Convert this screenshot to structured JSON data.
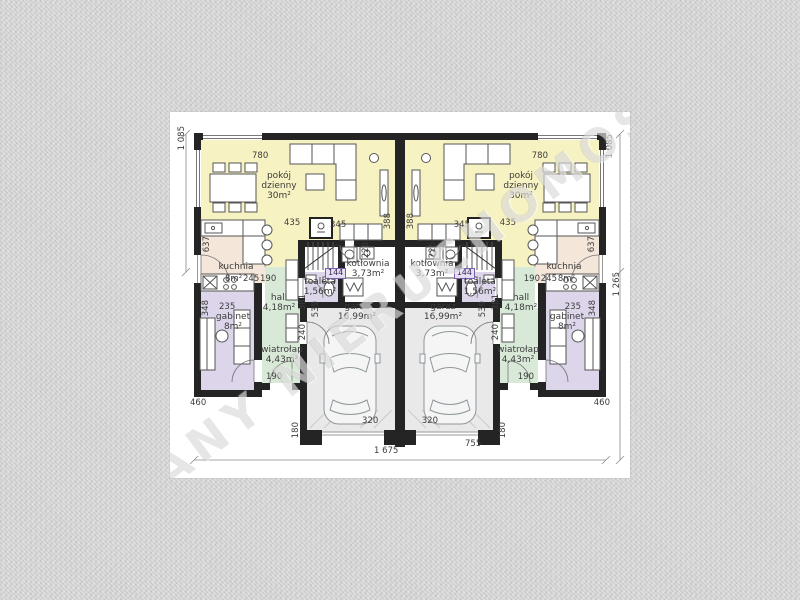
{
  "watermark": "PLANY NIERUCHOMOŚCI",
  "rooms": {
    "living": {
      "name": "pokój dzienny",
      "area": "30m²"
    },
    "kitchen": {
      "name": "kuchnia",
      "area": "8m²"
    },
    "office": {
      "name": "gabinet",
      "area": "8m²"
    },
    "hall": {
      "name": "hall",
      "area": "4,18m²"
    },
    "vestibule": {
      "name": "wiatrołap",
      "area": "4,43m²"
    },
    "garage": {
      "name": "garaż",
      "area": "16,99m²"
    },
    "boiler": {
      "name": "kotłownia",
      "area": "3,73m²"
    },
    "toilet": {
      "name": "toaleta",
      "area": "1,56m²"
    }
  },
  "dims": {
    "d780": "780",
    "d1085": "1 085",
    "d1265": "1 265",
    "d1675": "1 675",
    "d755": "755",
    "d637": "637",
    "d435": "435",
    "d345": "345",
    "d388": "388",
    "d245": "245",
    "d190": "190",
    "d226": "226",
    "d144": "144",
    "d235": "235",
    "d348": "348",
    "d381": "381",
    "d240": "240",
    "d539": "539",
    "d460": "460",
    "d320": "320",
    "d180": "180"
  },
  "colors": {
    "living": "#f7f2c2",
    "kitchen": "#f4e6d9",
    "hall_vestibule": "#d9e9d8",
    "office_toilet": "#ddd6eb",
    "garage": "#e9e9e9",
    "boiler": "#ffffff",
    "wall": "#242424",
    "paper": "#ffffff",
    "background": "#d7d7d7"
  }
}
